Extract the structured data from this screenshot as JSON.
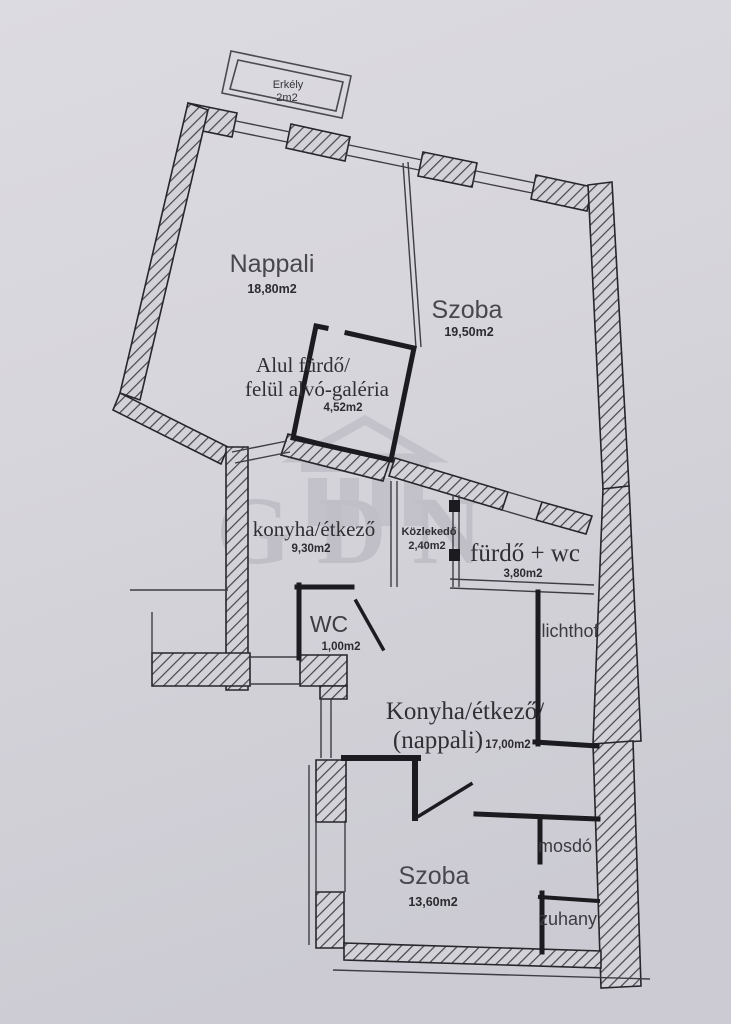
{
  "watermark": {
    "text": "GDN"
  },
  "colors": {
    "paper": "#d7d6dc",
    "wall": "#1b1b20",
    "hatch": "#45454c",
    "watermark": "#bdbcc5"
  },
  "rooms": {
    "erkely": {
      "name": "Erkély",
      "area": "2m2"
    },
    "nappali": {
      "name": "Nappali",
      "area": "18,80m2"
    },
    "szoba_upper": {
      "name": "Szoba",
      "area": "19,50m2"
    },
    "galeria": {
      "line1": "Alul fürdő/",
      "line2": "felül alvó-galéria",
      "area": "4,52m2"
    },
    "konyha_etkezo": {
      "name": "konyha/étkező",
      "area": "9,30m2"
    },
    "kozlekedo": {
      "name": "Közlekedő",
      "area": "2,40m2"
    },
    "furdo_wc": {
      "name": "fürdő + wc",
      "area": "3,80m2"
    },
    "wc": {
      "name": "WC",
      "area": "1,00m2"
    },
    "lichthof": {
      "name": "lichthof"
    },
    "konyha_nappali": {
      "line1": "Konyha/étkező/",
      "line2": "(nappali)",
      "area": "17,00m2"
    },
    "szoba_lower": {
      "name": "Szoba",
      "area": "13,60m2"
    },
    "mosdo": {
      "name": "mosdó"
    },
    "zuhany": {
      "name": "zuhany"
    }
  }
}
